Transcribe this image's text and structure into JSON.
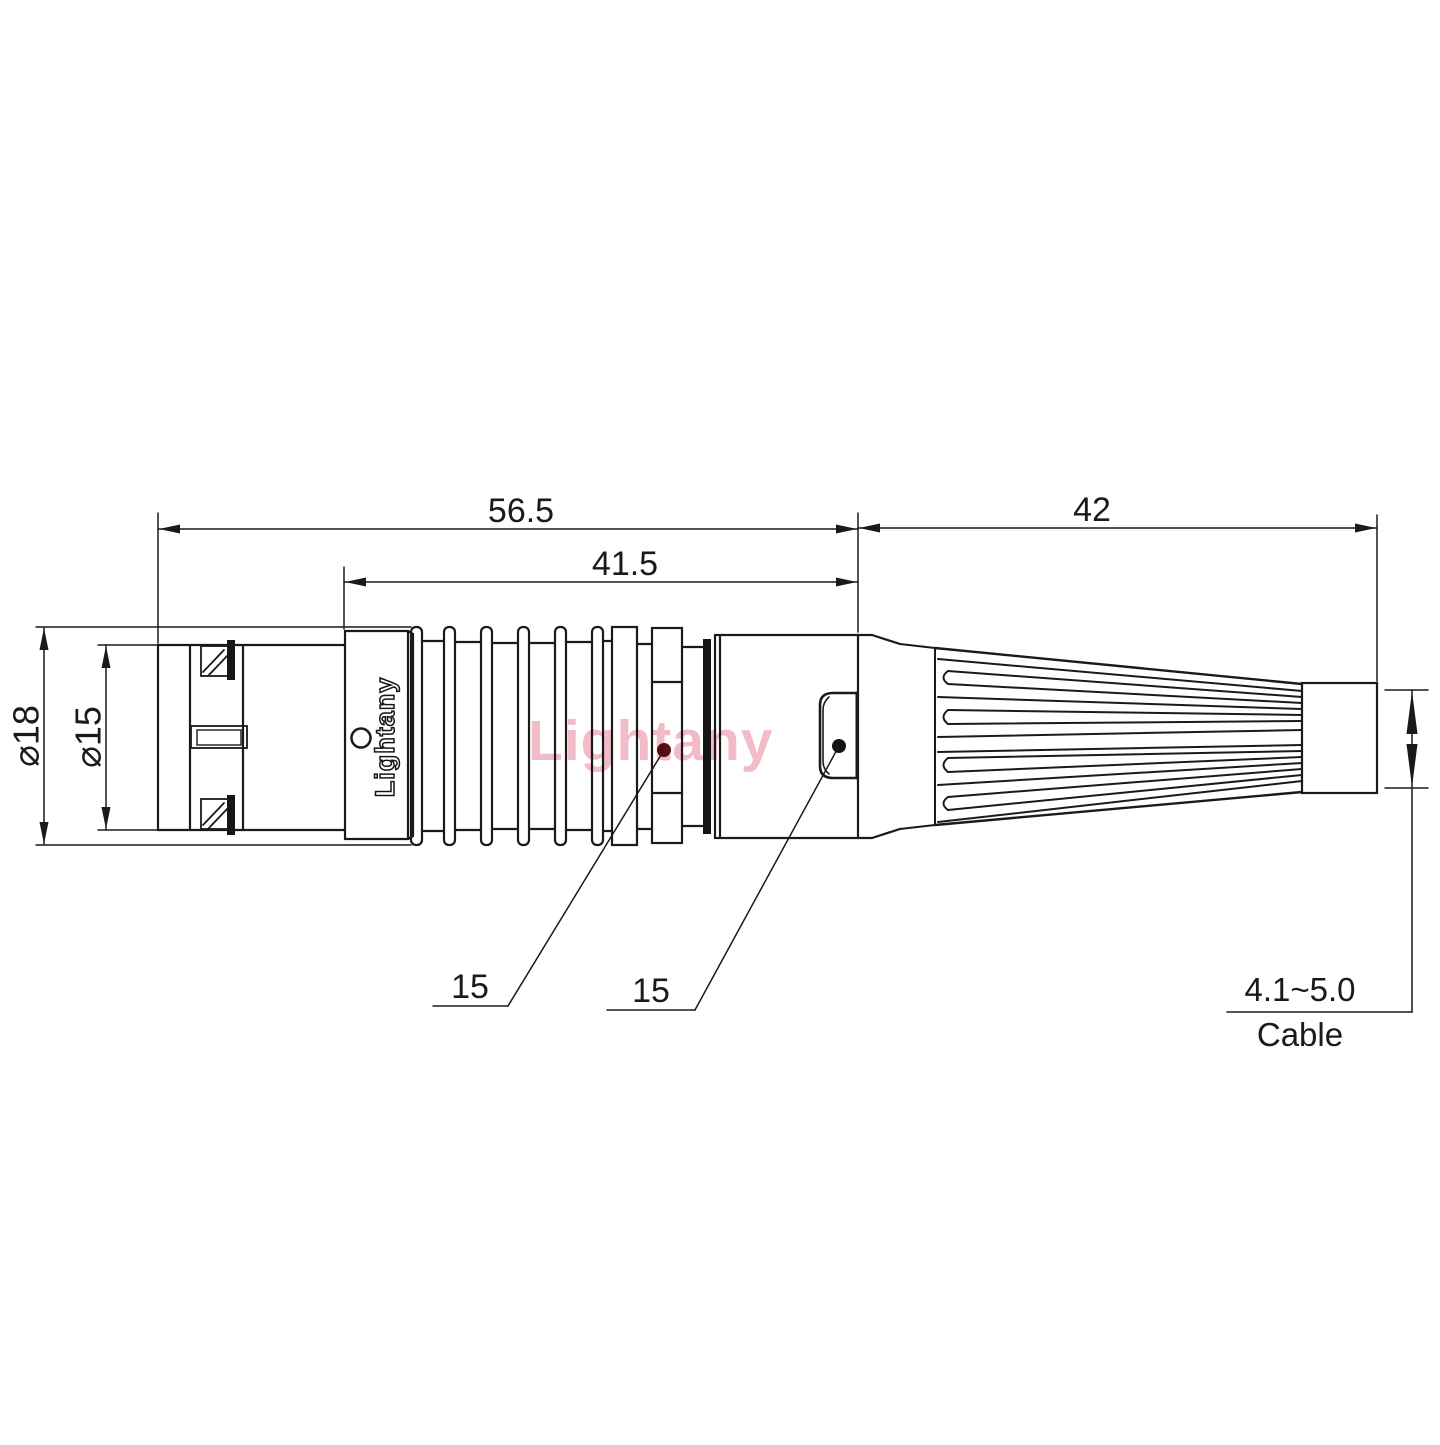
{
  "drawing": {
    "watermark": {
      "text": "Lightany"
    },
    "marking": {
      "text": "Lightany"
    },
    "dims": {
      "overall": "56.5",
      "body": "41.5",
      "boot": "42",
      "dia_outer": "⌀18",
      "dia_front": "⌀15",
      "callout1": "15",
      "callout2": "15",
      "cable_range": "4.1~5.0",
      "cable_word": "Cable"
    },
    "colors": {
      "line": "#1a1a1a",
      "watermark_pink": "#efb0bd",
      "leader_dot_red": "#551016",
      "leader_dot_black": "#141414"
    }
  }
}
